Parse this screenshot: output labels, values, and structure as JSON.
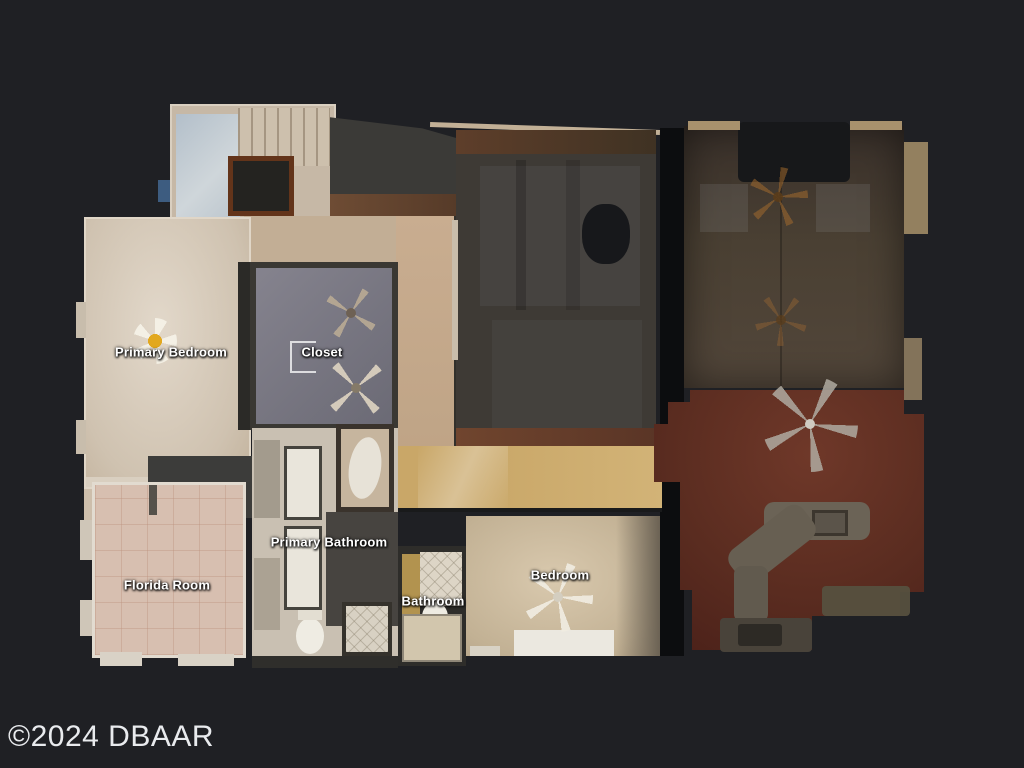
{
  "image_type": "real-estate 3D scan floor plan (top-down dollhouse view)",
  "watermark": {
    "text": "©2024 DBAAR"
  },
  "rooms": {
    "primary_bedroom": {
      "label": "Primary Bedroom"
    },
    "closet": {
      "label": "Closet"
    },
    "primary_bathroom": {
      "label": "Primary Bathroom"
    },
    "florida_room": {
      "label": "Florida Room"
    },
    "bathroom": {
      "label": "Bathroom"
    },
    "bedroom": {
      "label": "Bedroom"
    }
  },
  "icons": {
    "ceiling_fan": "ceiling-fan-icon",
    "fan_light": "fan-light-icon"
  },
  "colors": {
    "background": "#1f2024",
    "label_text": "#ffffff",
    "watermark_text": "#e9ebee",
    "bedroom_floor": "#d5c9bb",
    "closet_carpet": "#7b7a85",
    "florida_tile": "#d7bfb0",
    "hall_wood": "#cdab6e",
    "dark_room": "#3e3a35",
    "right_room": "#4a4033",
    "red_wood_floor": "#5d2e22",
    "counter_gray": "#6b6356"
  }
}
